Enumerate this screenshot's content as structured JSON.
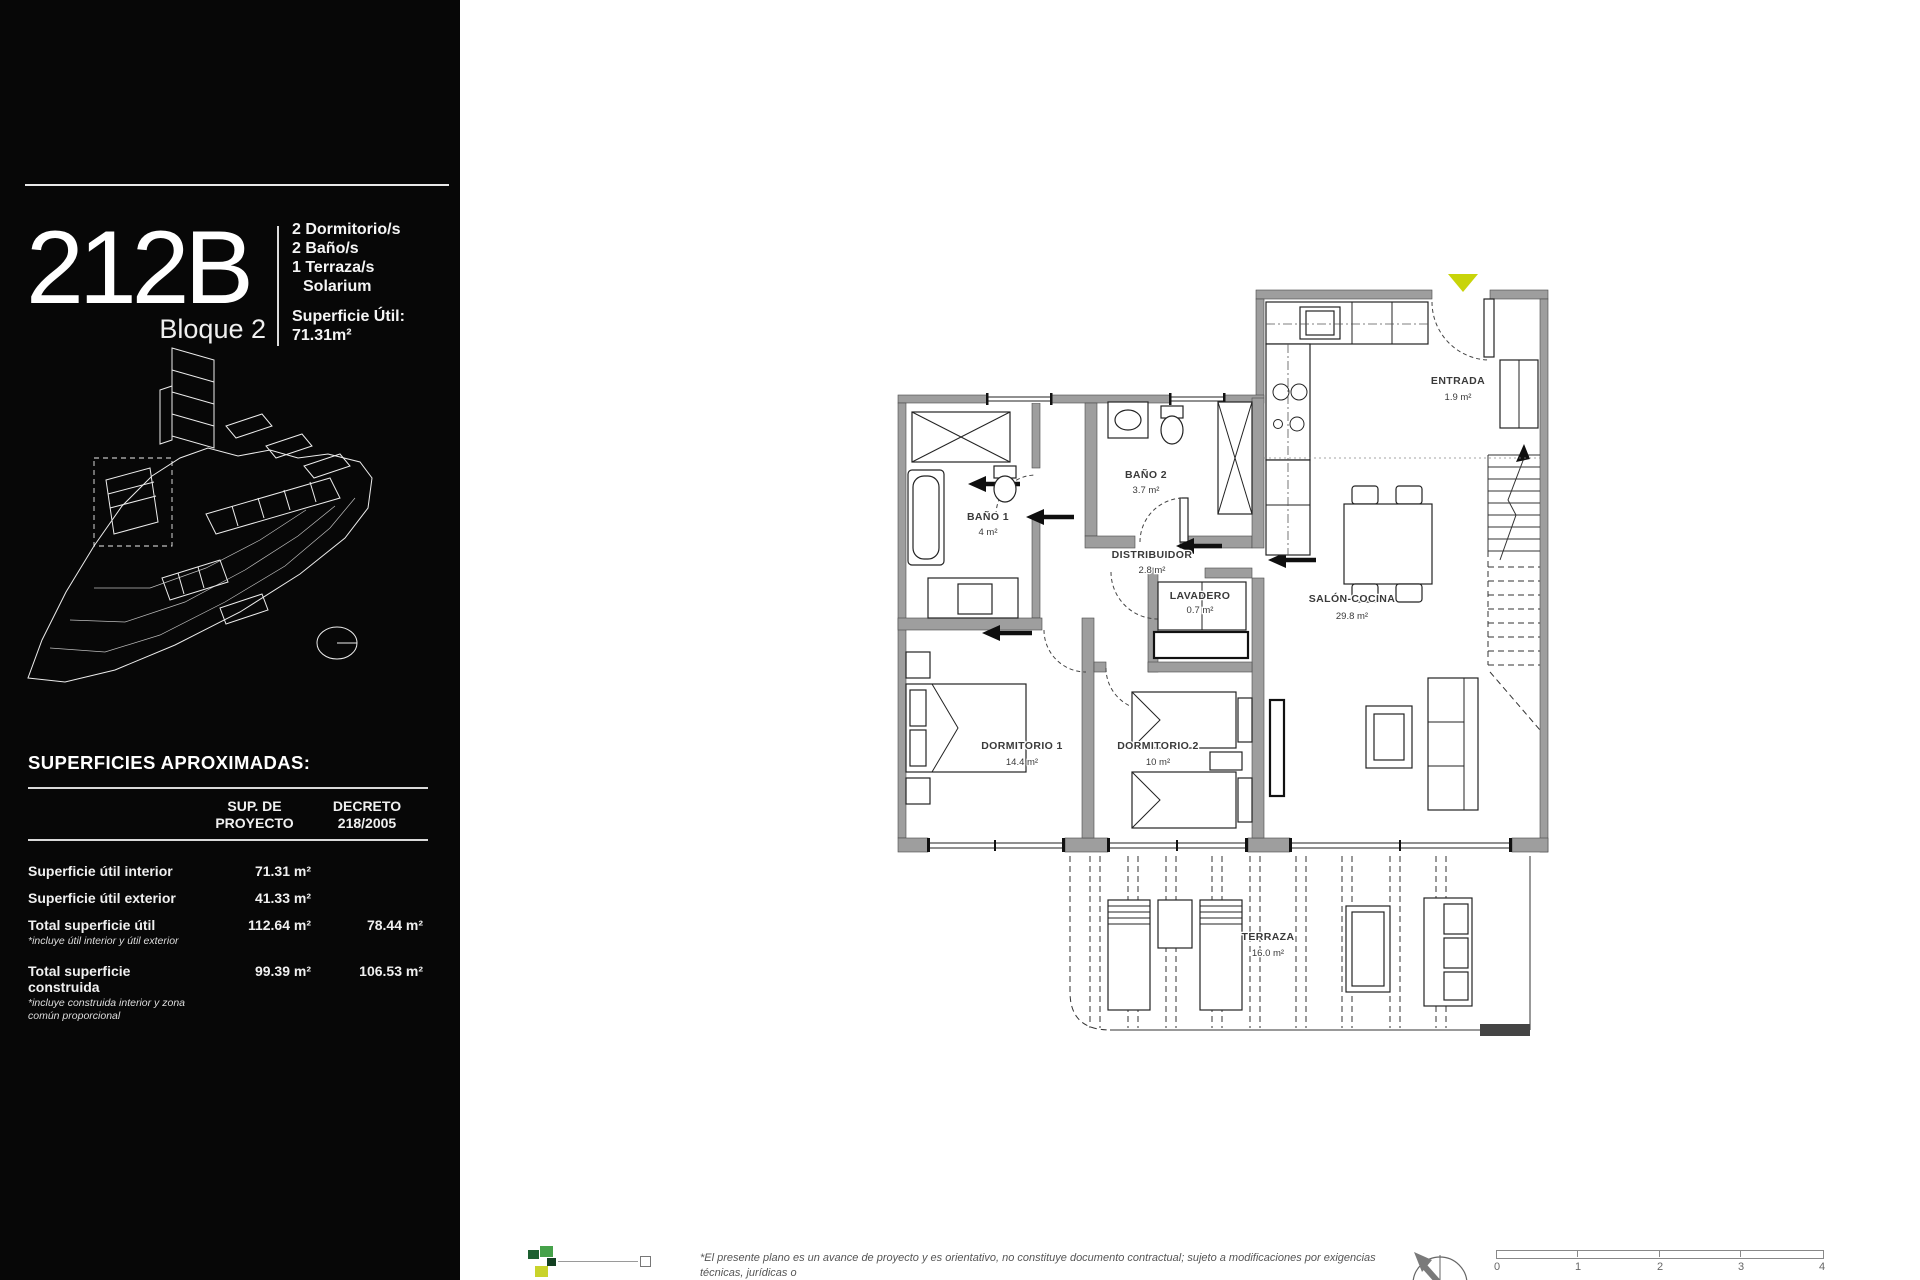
{
  "sidebar": {
    "unit_code": "212B",
    "block_label": "Bloque 2",
    "features": [
      "2 Dormitorio/s",
      "2 Baño/s",
      "1 Terraza/s",
      "Solarium"
    ],
    "surface_label": "Superficie Útil:",
    "surface_value": "71.31m²",
    "surfaces_table": {
      "title": "SUPERFICIES APROXIMADAS:",
      "col1_header_line1": "SUP. DE",
      "col1_header_line2": "PROYECTO",
      "col2_header_line1": "DECRETO",
      "col2_header_line2": "218/2005",
      "rows": [
        {
          "label": "Superficie útil interior",
          "col1": "71.31 m²",
          "col2": ""
        },
        {
          "label": "Superficie útil exterior",
          "col1": "41.33 m²",
          "col2": ""
        },
        {
          "label": "Total superficie útil",
          "note1": "*incluye útil interior y útil exterior",
          "col1": "112.64 m²",
          "col2": "78.44 m²"
        },
        {
          "label": "Total superficie construida",
          "note1": "*incluye construida interior y zona",
          "note2": "común proporcional",
          "col1": "99.39 m²",
          "col2": "106.53 m²"
        }
      ]
    }
  },
  "plan": {
    "rooms": {
      "entrada": {
        "name": "ENTRADA",
        "area": "1.9 m²"
      },
      "banyo1": {
        "name": "BAÑO 1",
        "area": "4 m²"
      },
      "banyo2": {
        "name": "BAÑO 2",
        "area": "3.7 m²"
      },
      "distribuidor": {
        "name": "DISTRIBUIDOR",
        "area": "2.8 m²"
      },
      "lavadero": {
        "name": "LAVADERO",
        "area": "0.7 m²"
      },
      "salon": {
        "name": "SALÓN-COCINA",
        "area": "29.8 m²"
      },
      "dormitorio1": {
        "name": "DORMITORIO 1",
        "area": "14.4 m²"
      },
      "dormitorio2": {
        "name": "DORMITORIO 2",
        "area": "10 m²"
      },
      "terraza": {
        "name": "TERRAZA",
        "area": "16.0 m²"
      }
    },
    "colors": {
      "entrance_marker": "#c8d409",
      "wall": "#9e9e9e"
    }
  },
  "footer": {
    "disclaimer_line1": "*El presente plano es un avance de proyecto y es orientativo, no constituye documento contractual; sujeto a modificaciones por exigencias técnicas, jurídicas o",
    "disclaimer_line2": "administrativas derivadas de la obtención de todos los permisos y licencias, reglamentados, así como las necesidades constructivas o de diseño derivadas del",
    "scale_ticks": [
      "0",
      "1",
      "2",
      "3",
      "4"
    ]
  }
}
